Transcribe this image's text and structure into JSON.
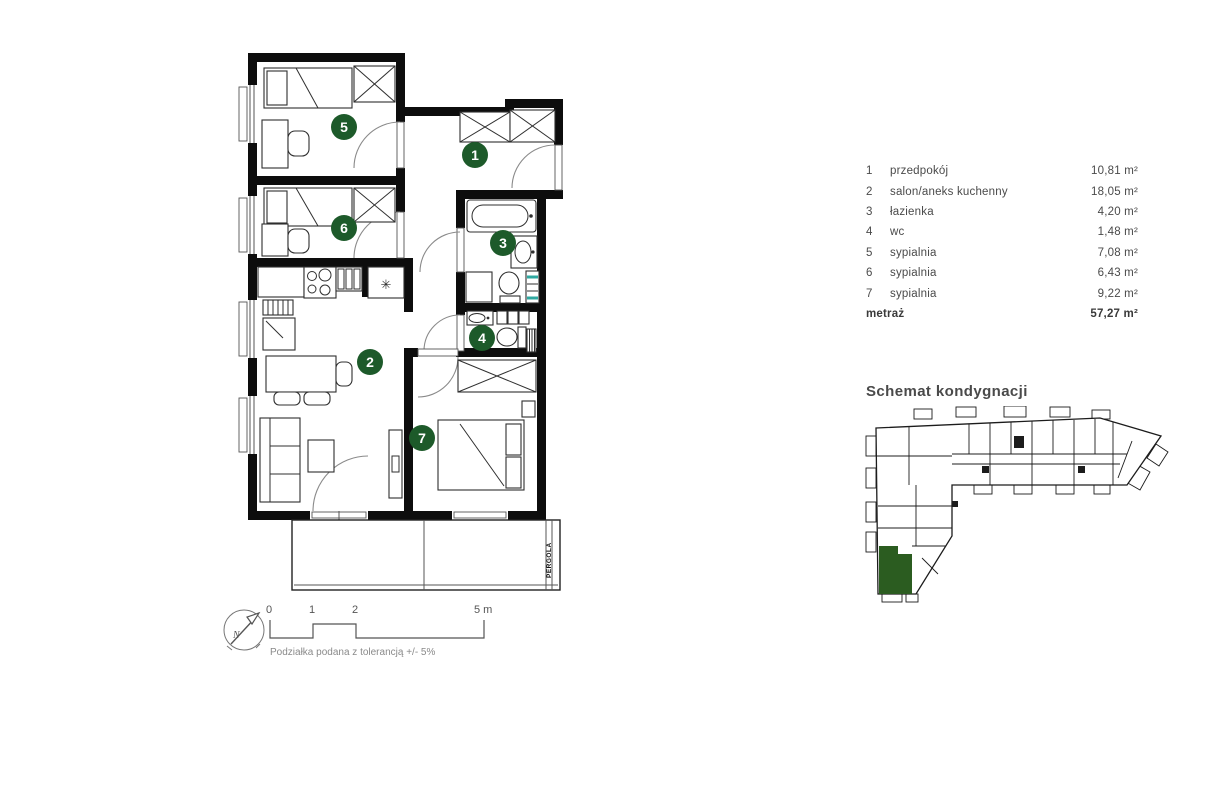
{
  "plan": {
    "rooms": [
      {
        "num": "1"
      },
      {
        "num": "2"
      },
      {
        "num": "3"
      },
      {
        "num": "4"
      },
      {
        "num": "5"
      },
      {
        "num": "6"
      },
      {
        "num": "7"
      }
    ],
    "pergola_label": "PERGOLA",
    "fridge_symbol": "✳",
    "compass_n": "N",
    "scale": {
      "t0": "0",
      "t1": "1",
      "t2": "2",
      "t5": "5 m",
      "note": "Podziałka podana z tolerancją +/- 5%"
    }
  },
  "legend": {
    "rows": [
      {
        "num": "1",
        "name": "przedpokój",
        "area": "10,81 m²"
      },
      {
        "num": "2",
        "name": "salon/aneks kuchenny",
        "area": "18,05 m²"
      },
      {
        "num": "3",
        "name": "łazienka",
        "area": "4,20 m²"
      },
      {
        "num": "4",
        "name": "wc",
        "area": "1,48 m²"
      },
      {
        "num": "5",
        "name": "sypialnia",
        "area": "7,08 m²"
      },
      {
        "num": "6",
        "name": "sypialnia",
        "area": "6,43 m²"
      },
      {
        "num": "7",
        "name": "sypialnia",
        "area": "9,22 m²"
      }
    ],
    "total_label": "metraż",
    "total_area": "57,27 m²"
  },
  "schematic": {
    "title": "Schemat kondygnacji"
  },
  "colors": {
    "accent_green": "#1d5a2a",
    "unit_green": "#2b5c20",
    "teal": "#2fa8a0"
  }
}
